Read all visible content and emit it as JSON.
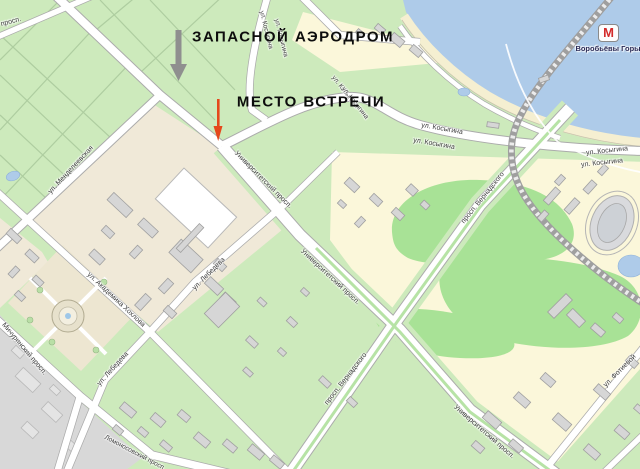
{
  "annotations": {
    "airfield": "ЗАПАСНОЙ АЭРОДРОМ",
    "meeting": "МЕСТО ВСТРЕЧИ"
  },
  "metro": {
    "symbol": "М",
    "name": "Воробьёвы Горы"
  },
  "streets": [
    {
      "label": "ул. Косыгина",
      "x": 266,
      "y": 30,
      "rot": 76,
      "size": 6.5
    },
    {
      "label": "ул. Косыгина",
      "x": 281,
      "y": 38,
      "rot": 76,
      "size": 6.5
    },
    {
      "label": "ул. Косыгина",
      "x": 345,
      "y": 92,
      "rot": 52,
      "size": 6.5
    },
    {
      "label": "ул. Косыгина",
      "x": 355,
      "y": 103,
      "rot": 52,
      "size": 6.5
    },
    {
      "label": "ул. Косыгина",
      "x": 442,
      "y": 129,
      "rot": 10,
      "size": 7
    },
    {
      "label": "ул. Косыгина",
      "x": 434,
      "y": 144,
      "rot": 10,
      "size": 7
    },
    {
      "label": "ул. Косыгина",
      "x": 607,
      "y": 151,
      "rot": -6,
      "size": 7
    },
    {
      "label": "ул. Косыгина",
      "x": 602,
      "y": 163,
      "rot": -6,
      "size": 7
    },
    {
      "label": "ул. Менделеевская",
      "x": 71,
      "y": 170,
      "rot": -47,
      "size": 7
    },
    {
      "label": "Университетский просп.",
      "x": 263,
      "y": 180,
      "rot": 45,
      "size": 7
    },
    {
      "label": "Университетский просп.",
      "x": 330,
      "y": 277,
      "rot": 43,
      "size": 7
    },
    {
      "label": "Университетский просп.",
      "x": 484,
      "y": 432,
      "rot": 41,
      "size": 7
    },
    {
      "label": "ул. Лебедева",
      "x": 209,
      "y": 274,
      "rot": -45,
      "size": 7
    },
    {
      "label": "ул. Лебедева",
      "x": 113,
      "y": 369,
      "rot": -48,
      "size": 7
    },
    {
      "label": "ул. Академика Хохлова",
      "x": 116,
      "y": 300,
      "rot": 43,
      "size": 7
    },
    {
      "label": "просп. Вернадского",
      "x": 483,
      "y": 198,
      "rot": -51,
      "size": 7
    },
    {
      "label": "просп. Вернадского",
      "x": 346,
      "y": 379,
      "rot": -52,
      "size": 7
    },
    {
      "label": "ул. Фотиевой",
      "x": 620,
      "y": 371,
      "rot": -45,
      "size": 7
    },
    {
      "label": "Мичуринский просп.",
      "x": 24,
      "y": 349,
      "rot": 50,
      "size": 7
    },
    {
      "label": "Ломоносовский просп.",
      "x": 135,
      "y": 453,
      "rot": 28,
      "size": 6.5
    },
    {
      "label": "просп.",
      "x": 11,
      "y": 22,
      "rot": -15,
      "size": 7
    }
  ],
  "colors": {
    "park_green": "#cdeabc",
    "woods_green": "#a8e296",
    "block_yellow": "#fbf7da",
    "block_beige": "#f0e9d8",
    "river_blue": "#aecbe9",
    "road_white": "#ffffff",
    "metro_red": "#d32b2b",
    "arrow_gray": "#8f8f8f",
    "arrow_red": "#e5481c"
  }
}
